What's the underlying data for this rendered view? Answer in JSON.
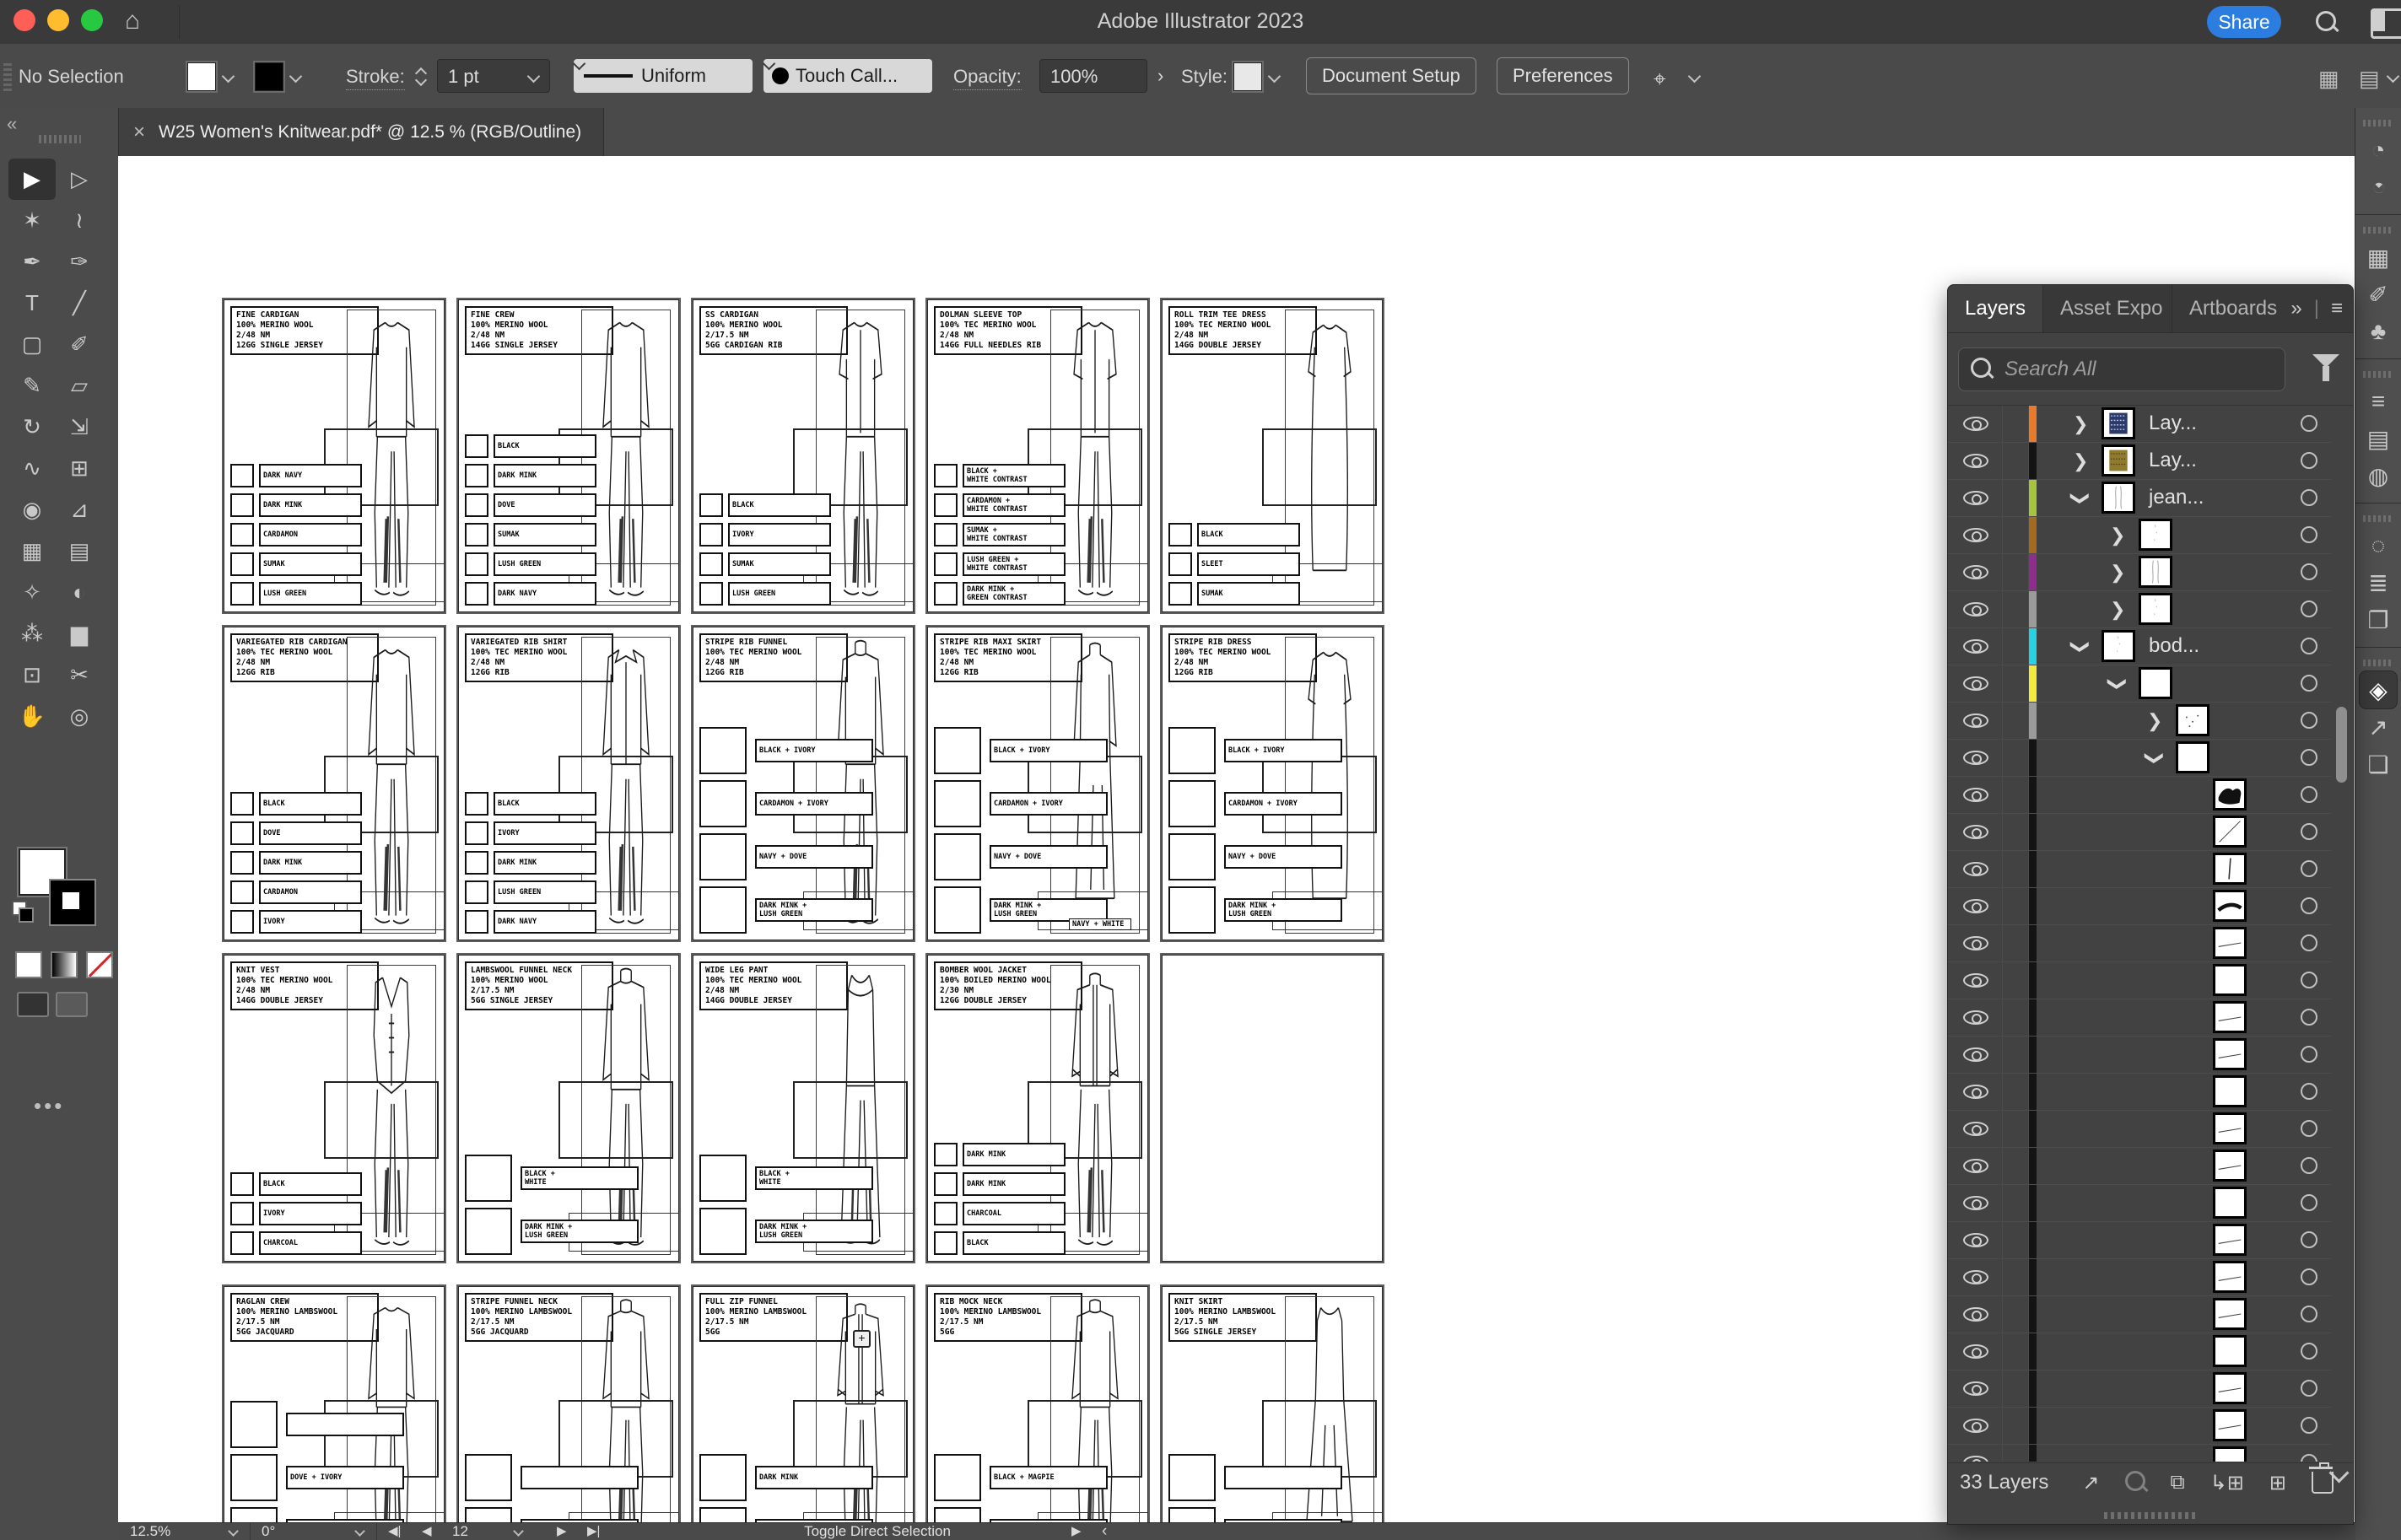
{
  "titlebar": {
    "title": "Adobe Illustrator 2023",
    "share_label": "Share"
  },
  "controlbar": {
    "selection_status": "No Selection",
    "stroke_label": "Stroke:",
    "stroke_value": "1 pt",
    "profile_value": "Uniform",
    "brush_value": "Touch Call...",
    "opacity_label": "Opacity:",
    "opacity_value": "100%",
    "style_label": "Style:",
    "document_setup_label": "Document Setup",
    "preferences_label": "Preferences"
  },
  "tab": {
    "close_glyph": "×",
    "title": "W25 Women's Knitwear.pdf* @ 12.5 % (RGB/Outline)"
  },
  "toolbar": {
    "collapse_glyph": "«",
    "more_glyph": "•••",
    "tools": [
      {
        "name": "selection-tool",
        "glyph": "▶",
        "active": true
      },
      {
        "name": "direct-selection-tool",
        "glyph": "▷"
      },
      {
        "name": "magic-wand-tool",
        "glyph": "✶"
      },
      {
        "name": "lasso-tool",
        "glyph": "≀"
      },
      {
        "name": "pen-tool",
        "glyph": "✒"
      },
      {
        "name": "curvature-tool",
        "glyph": "✑"
      },
      {
        "name": "type-tool",
        "glyph": "T"
      },
      {
        "name": "line-segment-tool",
        "glyph": "╱"
      },
      {
        "name": "rectangle-tool",
        "glyph": "▢"
      },
      {
        "name": "paintbrush-tool",
        "glyph": "✐"
      },
      {
        "name": "shaper-tool",
        "glyph": "✎"
      },
      {
        "name": "eraser-tool",
        "glyph": "▱"
      },
      {
        "name": "rotate-tool",
        "glyph": "↻"
      },
      {
        "name": "scale-tool",
        "glyph": "⇲"
      },
      {
        "name": "width-tool",
        "glyph": "∿"
      },
      {
        "name": "free-transform-tool",
        "glyph": "⊞"
      },
      {
        "name": "shape-builder-tool",
        "glyph": "◉"
      },
      {
        "name": "perspective-grid-tool",
        "glyph": "⊿"
      },
      {
        "name": "mesh-tool",
        "glyph": "▦"
      },
      {
        "name": "gradient-tool",
        "glyph": "▤"
      },
      {
        "name": "eyedropper-tool",
        "glyph": "✧"
      },
      {
        "name": "blend-tool",
        "glyph": "◐"
      },
      {
        "name": "symbol-sprayer-tool",
        "glyph": "⁂"
      },
      {
        "name": "column-graph-tool",
        "glyph": "▆"
      },
      {
        "name": "artboard-tool",
        "glyph": "⊡"
      },
      {
        "name": "slice-tool",
        "glyph": "✂"
      },
      {
        "name": "hand-tool",
        "glyph": "✋"
      },
      {
        "name": "zoom-tool",
        "glyph": "◎"
      }
    ]
  },
  "canvas": {
    "cards": [
      {
        "row": 0,
        "col": 0,
        "variant": "ls",
        "size": "s",
        "title": [
          "FINE CARDIGAN",
          "100% MERINO WOOL",
          "2/48 NM",
          "12GG SINGLE JERSEY"
        ],
        "swatches": [
          {
            "t": "LUSH GREEN"
          },
          {
            "t": "SUMAK"
          },
          {
            "t": "CARDAMON"
          },
          {
            "t": "DARK MINK"
          },
          {
            "t": "DARK NAVY"
          }
        ]
      },
      {
        "row": 0,
        "col": 1,
        "variant": "ls",
        "size": "s",
        "title": [
          "FINE CREW",
          "100% MERINO WOOL",
          "2/48 NM",
          "14GG SINGLE JERSEY"
        ],
        "swatches": [
          {
            "t": "DARK NAVY"
          },
          {
            "t": "LUSH GREEN"
          },
          {
            "t": "SUMAK"
          },
          {
            "t": "DOVE"
          },
          {
            "t": "DARK MINK"
          },
          {
            "t": "BLACK"
          }
        ]
      },
      {
        "row": 0,
        "col": 2,
        "variant": "ss",
        "size": "s",
        "title": [
          "SS CARDIGAN",
          "100% MERINO WOOL",
          "2/17.5 NM",
          "5GG CARDIGAN RIB"
        ],
        "swatches": [
          {
            "t": "LUSH GREEN"
          },
          {
            "t": "SUMAK"
          },
          {
            "t": "IVORY"
          },
          {
            "t": "BLACK"
          }
        ]
      },
      {
        "row": 0,
        "col": 3,
        "variant": "ss",
        "size": "s",
        "title": [
          "DOLMAN SLEEVE TOP",
          "100% TEC MERINO WOOL",
          "2/48 NM",
          "14GG FULL NEEDLES RIB"
        ],
        "swatches": [
          {
            "t": "DARK MINK +",
            "t2": "GREEN CONTRAST"
          },
          {
            "t": "LUSH GREEN +",
            "t2": "WHITE CONTRAST"
          },
          {
            "t": "SUMAK +",
            "t2": "WHITE CONTRAST"
          },
          {
            "t": "CARDAMON +",
            "t2": "WHITE CONTRAST"
          },
          {
            "t": "BLACK +",
            "t2": "WHITE CONTRAST"
          }
        ]
      },
      {
        "row": 0,
        "col": 4,
        "variant": "dress",
        "size": "s",
        "title": [
          "ROLL TRIM TEE DRESS",
          "100% TEC MERINO WOOL",
          "2/48 NM",
          "14GG DOUBLE JERSEY"
        ],
        "swatches": [
          {
            "t": "SUMAK"
          },
          {
            "t": "SLEET"
          },
          {
            "t": "BLACK"
          }
        ]
      },
      {
        "row": 1,
        "col": 0,
        "variant": "ls",
        "size": "s",
        "title": [
          "VARIEGATED RIB CARDIGAN",
          "100% TEC MERINO WOOL",
          "2/48 NM",
          "12GG RIB"
        ],
        "swatches": [
          {
            "t": "IVORY"
          },
          {
            "t": "CARDAMON"
          },
          {
            "t": "DARK MINK"
          },
          {
            "t": "DOVE"
          },
          {
            "t": "BLACK"
          }
        ]
      },
      {
        "row": 1,
        "col": 1,
        "variant": "collared",
        "size": "s",
        "title": [
          "VARIEGATED RIB SHIRT",
          "100% TEC MERINO WOOL",
          "2/48 NM",
          "12GG RIB"
        ],
        "swatches": [
          {
            "t": "DARK NAVY"
          },
          {
            "t": "LUSH GREEN"
          },
          {
            "t": "DARK MINK"
          },
          {
            "t": "IVORY"
          },
          {
            "t": "BLACK"
          }
        ]
      },
      {
        "row": 1,
        "col": 2,
        "variant": "funnel",
        "size": "l",
        "title": [
          "STRIPE RIB FUNNEL",
          "100% TEC MERINO WOOL",
          "2/48 NM",
          "12GG RIB"
        ],
        "swatches": [
          {
            "t": "DARK MINK +",
            "t2": "LUSH GREEN"
          },
          {
            "t": "NAVY + DOVE"
          },
          {
            "t": "CARDAMON + IVORY"
          },
          {
            "t": "BLACK + IVORY"
          }
        ]
      },
      {
        "row": 1,
        "col": 3,
        "variant": "maxi",
        "size": "l",
        "extra": "NAVY + WHITE",
        "title": [
          "STRIPE RIB MAXI SKIRT",
          "100% TEC MERINO WOOL",
          "2/48 NM",
          "12GG RIB"
        ],
        "swatches": [
          {
            "t": "DARK MINK +",
            "t2": "LUSH GREEN"
          },
          {
            "t": "NAVY + DOVE"
          },
          {
            "t": "CARDAMON + IVORY"
          },
          {
            "t": "BLACK + IVORY"
          }
        ]
      },
      {
        "row": 1,
        "col": 4,
        "variant": "dress",
        "size": "l",
        "title": [
          "STRIPE RIB DRESS",
          "100% TEC MERINO WOOL",
          "2/48 NM",
          "12GG RIB"
        ],
        "swatches": [
          {
            "t": "DARK MINK +",
            "t2": "LUSH GREEN"
          },
          {
            "t": "NAVY + DOVE"
          },
          {
            "t": "CARDAMON + IVORY"
          },
          {
            "t": "BLACK + IVORY"
          }
        ]
      },
      {
        "row": 2,
        "col": 0,
        "variant": "vest",
        "size": "s",
        "title": [
          "KNIT VEST",
          "100% TEC MERINO WOOL",
          "2/48 NM",
          "14GG DOUBLE JERSEY"
        ],
        "swatches": [
          {
            "t": "CHARCOAL"
          },
          {
            "t": "IVORY"
          },
          {
            "t": "BLACK"
          }
        ]
      },
      {
        "row": 2,
        "col": 1,
        "variant": "funnel",
        "size": "l",
        "title": [
          "LAMBSWOOL FUNNEL NECK",
          "100% MERINO WOOL",
          "2/17.5 NM",
          "5GG SINGLE JERSEY"
        ],
        "swatches": [
          {
            "t": "DARK MINK +",
            "t2": "LUSH GREEN"
          },
          {
            "t": "BLACK +",
            "t2": "WHITE"
          }
        ]
      },
      {
        "row": 2,
        "col": 2,
        "variant": "tank",
        "size": "l",
        "title": [
          "WIDE LEG PANT",
          "100% TEC MERINO WOOL",
          "2/48 NM",
          "14GG DOUBLE JERSEY"
        ],
        "swatches": [
          {
            "t": "DARK MINK +",
            "t2": "LUSH GREEN"
          },
          {
            "t": "BLACK +",
            "t2": "WHITE"
          }
        ]
      },
      {
        "row": 2,
        "col": 3,
        "variant": "jacket",
        "size": "s",
        "title": [
          "BOMBER WOOL JACKET",
          "100% BOILED MERINO WOOL",
          "2/30 NM",
          "12GG DOUBLE JERSEY"
        ],
        "swatches": [
          {
            "t": "BLACK"
          },
          {
            "t": "CHARCOAL"
          },
          {
            "t": "DARK MINK"
          },
          {
            "t": "DARK MINK"
          }
        ]
      },
      {
        "row": 2,
        "col": 4,
        "variant": "none",
        "size": "s",
        "title": [],
        "swatches": []
      },
      {
        "row": 3,
        "col": 0,
        "variant": "ls",
        "size": "l",
        "title": [
          "RAGLAN CREW",
          "100% MERINO LAMBSWOOL",
          "2/17.5 NM",
          "5GG JACQUARD"
        ],
        "swatches": [
          {
            "t": "SUMAK + MID GREY"
          },
          {
            "t": "DOVE + IVORY"
          },
          {
            "t": ""
          }
        ]
      },
      {
        "row": 3,
        "col": 1,
        "variant": "funnel",
        "size": "l",
        "title": [
          "STRIPE FUNNEL NECK",
          "100% MERINO LAMBSWOOL",
          "2/17.5 NM",
          "5GG JACQUARD"
        ],
        "swatches": [
          {
            "t": "DOVE + IVORY"
          },
          {
            "t": ""
          }
        ]
      },
      {
        "row": 3,
        "col": 2,
        "variant": "jacket",
        "size": "l",
        "plus": true,
        "title": [
          "FULL ZIP FUNNEL",
          "100% MERINO LAMBSWOOL",
          "2/17.5 NM",
          "5GG"
        ],
        "swatches": [
          {
            "t": "MAGPIE"
          },
          {
            "t": "DARK MINK"
          }
        ]
      },
      {
        "row": 3,
        "col": 3,
        "variant": "funnel",
        "size": "l",
        "title": [
          "RIB MOCK NECK",
          "100% MERINO LAMBSWOOL",
          "2/17.5 NM",
          "5GG"
        ],
        "swatches": [
          {
            "t": "SUMAK + MID GREY"
          },
          {
            "t": "BLACK + MAGPIE"
          }
        ]
      },
      {
        "row": 3,
        "col": 4,
        "variant": "tankskirt",
        "size": "l",
        "title": [
          "KNIT SKIRT",
          "100% MERINO LAMBSWOOL",
          "2/17.5 NM",
          "5GG SINGLE JERSEY"
        ],
        "swatches": [
          {
            "t": "PUTTY"
          },
          {
            "t": ""
          }
        ]
      }
    ]
  },
  "layers_panel": {
    "tabs": [
      {
        "label": "Layers",
        "active": true
      },
      {
        "label": "Asset Expo",
        "active": false
      },
      {
        "label": "Artboards",
        "active": false
      }
    ],
    "header_icons": {
      "expand": "»",
      "divider": "|",
      "menu": "≡"
    },
    "search_placeholder": "Search All",
    "rows": [
      {
        "color": "#e87a2c",
        "arrow": ">",
        "indent": 1,
        "label": "Lay...",
        "thumb": "vest-navy"
      },
      {
        "color": "#141414",
        "arrow": ">",
        "indent": 1,
        "label": "Lay...",
        "thumb": "vest-olive"
      },
      {
        "color": "#a6c43c",
        "arrow": "v",
        "indent": 1,
        "label": "jean...",
        "thumb": "sketch"
      },
      {
        "color": "#a5691f",
        "arrow": ">",
        "indent": 2,
        "label": "",
        "thumb": "faint"
      },
      {
        "color": "#8f2d8f",
        "arrow": ">",
        "indent": 2,
        "label": "",
        "thumb": "sketch"
      },
      {
        "color": "#9b9b9b",
        "arrow": ">",
        "indent": 2,
        "label": "",
        "thumb": "faint"
      },
      {
        "color": "#27d3e2",
        "arrow": "v",
        "indent": 1,
        "label": "bod...",
        "thumb": "faint"
      },
      {
        "color": "#f3ea3e",
        "arrow": "v",
        "indent": 2,
        "label": "",
        "thumb": "blank"
      },
      {
        "color": "#9b9b9b",
        "arrow": ">",
        "indent": 3,
        "label": "",
        "thumb": "dots"
      },
      {
        "color": "#141414",
        "arrow": "v",
        "indent": 3,
        "label": "",
        "thumb": "blank"
      },
      {
        "color": "#141414",
        "arrow": "",
        "indent": 4,
        "label": "",
        "thumb": "shoe"
      },
      {
        "color": "#141414",
        "arrow": "",
        "indent": 4,
        "label": "",
        "thumb": "diag"
      },
      {
        "color": "#141414",
        "arrow": "",
        "indent": 4,
        "label": "",
        "thumb": "vline"
      },
      {
        "color": "#141414",
        "arrow": "",
        "indent": 4,
        "label": "",
        "thumb": "swoosh"
      },
      {
        "color": "#141414",
        "arrow": "",
        "indent": 4,
        "label": "",
        "thumb": "hline"
      },
      {
        "color": "#141414",
        "arrow": "",
        "indent": 4,
        "label": "",
        "thumb": "blank"
      },
      {
        "color": "#141414",
        "arrow": "",
        "indent": 4,
        "label": "",
        "thumb": "hline"
      },
      {
        "color": "#141414",
        "arrow": "",
        "indent": 4,
        "label": "",
        "thumb": "hline"
      },
      {
        "color": "#141414",
        "arrow": "",
        "indent": 4,
        "label": "",
        "thumb": "blank"
      },
      {
        "color": "#141414",
        "arrow": "",
        "indent": 4,
        "label": "",
        "thumb": "hline"
      },
      {
        "color": "#141414",
        "arrow": "",
        "indent": 4,
        "label": "",
        "thumb": "hline"
      },
      {
        "color": "#141414",
        "arrow": "",
        "indent": 4,
        "label": "",
        "thumb": "blank"
      },
      {
        "color": "#141414",
        "arrow": "",
        "indent": 4,
        "label": "",
        "thumb": "hline"
      },
      {
        "color": "#141414",
        "arrow": "",
        "indent": 4,
        "label": "",
        "thumb": "hline"
      },
      {
        "color": "#141414",
        "arrow": "",
        "indent": 4,
        "label": "",
        "thumb": "hline"
      },
      {
        "color": "#141414",
        "arrow": "",
        "indent": 4,
        "label": "",
        "thumb": "blank"
      },
      {
        "color": "#141414",
        "arrow": "",
        "indent": 4,
        "label": "",
        "thumb": "hline"
      },
      {
        "color": "#141414",
        "arrow": "",
        "indent": 4,
        "label": "",
        "thumb": "hline"
      },
      {
        "color": "#141414",
        "arrow": "",
        "indent": 4,
        "label": "",
        "thumb": "hline"
      }
    ],
    "footer": {
      "count_label": "33 Layers"
    }
  },
  "right_dock": {
    "icons": [
      {
        "name": "color-panel-icon",
        "glyph": "◔"
      },
      {
        "name": "color-guide-panel-icon",
        "glyph": "◔",
        "fan": true
      },
      {
        "name": "swatches-panel-icon",
        "glyph": "▦",
        "group": true
      },
      {
        "name": "brushes-panel-icon",
        "glyph": "✐"
      },
      {
        "name": "symbols-panel-icon",
        "glyph": "♣"
      },
      {
        "name": "stroke-panel-icon",
        "glyph": "≡",
        "group": true
      },
      {
        "name": "gradient-panel-icon",
        "glyph": "▤"
      },
      {
        "name": "transparency-panel-icon",
        "glyph": "◍"
      },
      {
        "name": "css-properties-panel-icon",
        "glyph": "◌",
        "group": true
      },
      {
        "name": "align-panel-icon",
        "glyph": "≣"
      },
      {
        "name": "transform-panel-icon",
        "glyph": "❐"
      },
      {
        "name": "layers-panel-icon",
        "glyph": "◈",
        "group": true,
        "active": true
      },
      {
        "name": "asset-export-panel-icon",
        "glyph": "↗"
      },
      {
        "name": "artboards-panel-icon",
        "glyph": "❏"
      }
    ]
  },
  "statusbar": {
    "zoom_value": "12.5%",
    "rotation_value": "0°",
    "artboard_value": "12",
    "nav_first": "◀|",
    "nav_prev": "◀",
    "nav_next": "▶",
    "nav_last": "▶|",
    "status_text": "Toggle Direct Selection",
    "right_play": "▶",
    "right_back": "‹"
  }
}
